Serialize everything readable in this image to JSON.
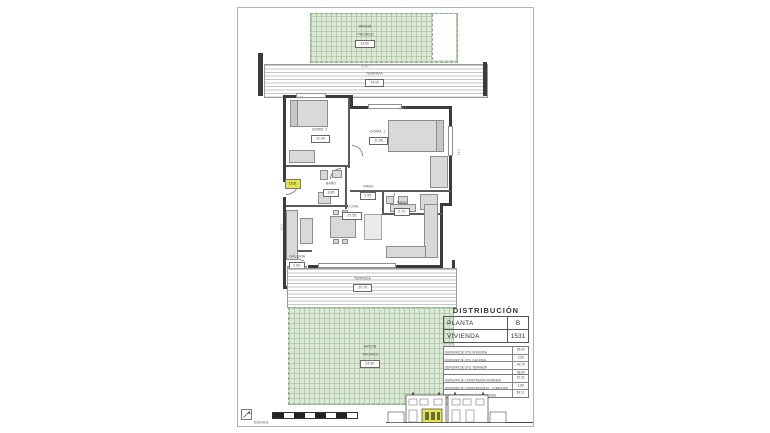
{
  "colors": {
    "garden_green": "#dce9d6",
    "wall_dark": "#3b3b3b",
    "highlight_yellow": "#e4e450"
  },
  "plan": {
    "jardin_top": {
      "line1": "JARDIN",
      "line2": "PRIVADO",
      "area": "13.50"
    },
    "terraza_top": {
      "label": "TERRAZA",
      "area": "14.00"
    },
    "dorm2": {
      "label": "DORM. 2",
      "area": "11.40"
    },
    "dorm1": {
      "label": "DORM. 1",
      "area": "11.90"
    },
    "bano": {
      "label": "BAÑO",
      "area": "3.85"
    },
    "paso": {
      "label": "PASO",
      "area": "3.95"
    },
    "aseo": {
      "label": "ASEO",
      "area": "2.70"
    },
    "salon": {
      "label": "S.COM.",
      "area": "27.55"
    },
    "galeria": {
      "label": "GALERIA",
      "area": "2.60"
    },
    "terraza_bottom": {
      "label": "TERRAZA",
      "area": "29.70"
    },
    "jardin_bottom": {
      "line1": "JARDIN",
      "line2": "PRIVADO",
      "area": "24.50"
    },
    "unit_badge": "1531",
    "dims": [
      "5.00",
      "1.40",
      "2.47",
      "2.41",
      "3.01",
      "4.46"
    ]
  },
  "distribucion": {
    "title": "DISTRIBUCIÓN",
    "main_table": {
      "rows": [
        {
          "label": "PLANTA",
          "value": "B"
        },
        {
          "label": "VIVIENDA",
          "value": "1531"
        }
      ]
    },
    "areas_table": {
      "rows": [
        {
          "label": "SUPERFICIE ÚTIL VIVIENDA",
          "value": "59.20"
        },
        {
          "label": "SUPERFICIE ÚTIL GALERIA",
          "value": "2.60"
        },
        {
          "label": "SUPERFICIE ÚTIL TERRAZA",
          "value": "43.70"
        },
        {
          "label": "SUPERFICIE JARDÍN PRIVADO",
          "value": "38.00"
        }
      ]
    },
    "construida_table": {
      "rows": [
        {
          "label": "SUPERFICIE CONSTRUIDA VIVIENDA",
          "value": "67.31"
        },
        {
          "label": "SUPERFICIE CONSTRUIDA EL. COMUNES",
          "value": "1.80"
        },
        {
          "label": "TOTAL SUPERFICIE CONSTRUIDA",
          "value": "69.11"
        }
      ]
    }
  },
  "footer": {
    "escala": "ESCALA"
  }
}
